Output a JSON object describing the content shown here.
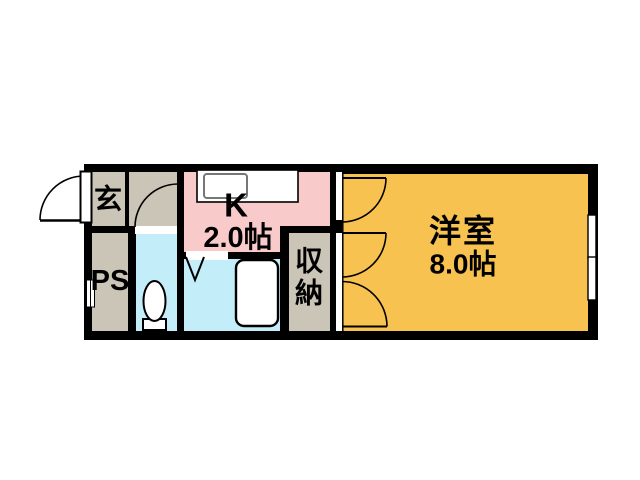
{
  "colors": {
    "background": "#ffffff",
    "wall": "#000000",
    "hallway": "#cbc5b7",
    "kitchen": "#f9caca",
    "wet_area": "#c2edf9",
    "living_room": "#f8c250",
    "fixture": "#ffffff"
  },
  "rooms": {
    "entrance": {
      "label": "玄"
    },
    "pipe_space": {
      "label": "PS"
    },
    "kitchen": {
      "label": "K",
      "size": "2.0帖"
    },
    "storage": {
      "label_char_1": "収",
      "label_char_2": "納"
    },
    "western_room": {
      "label": "洋室",
      "size": "8.0帖"
    }
  },
  "fixtures": {
    "toilet": "toilet-icon",
    "bathtub": "bathtub-icon",
    "kitchen_sink": "kitchen-sink-icon",
    "kitchen_counter": "kitchen-counter",
    "window": "sliding-window",
    "entrance_door": "entrance-swing-door",
    "hall_door": "hall-swing-door",
    "room_door": "room-swing-door",
    "closet_doors": "closet-double-swing-doors",
    "bath_door": "bath-folding-door-mark",
    "meter_box": "meter-box"
  }
}
